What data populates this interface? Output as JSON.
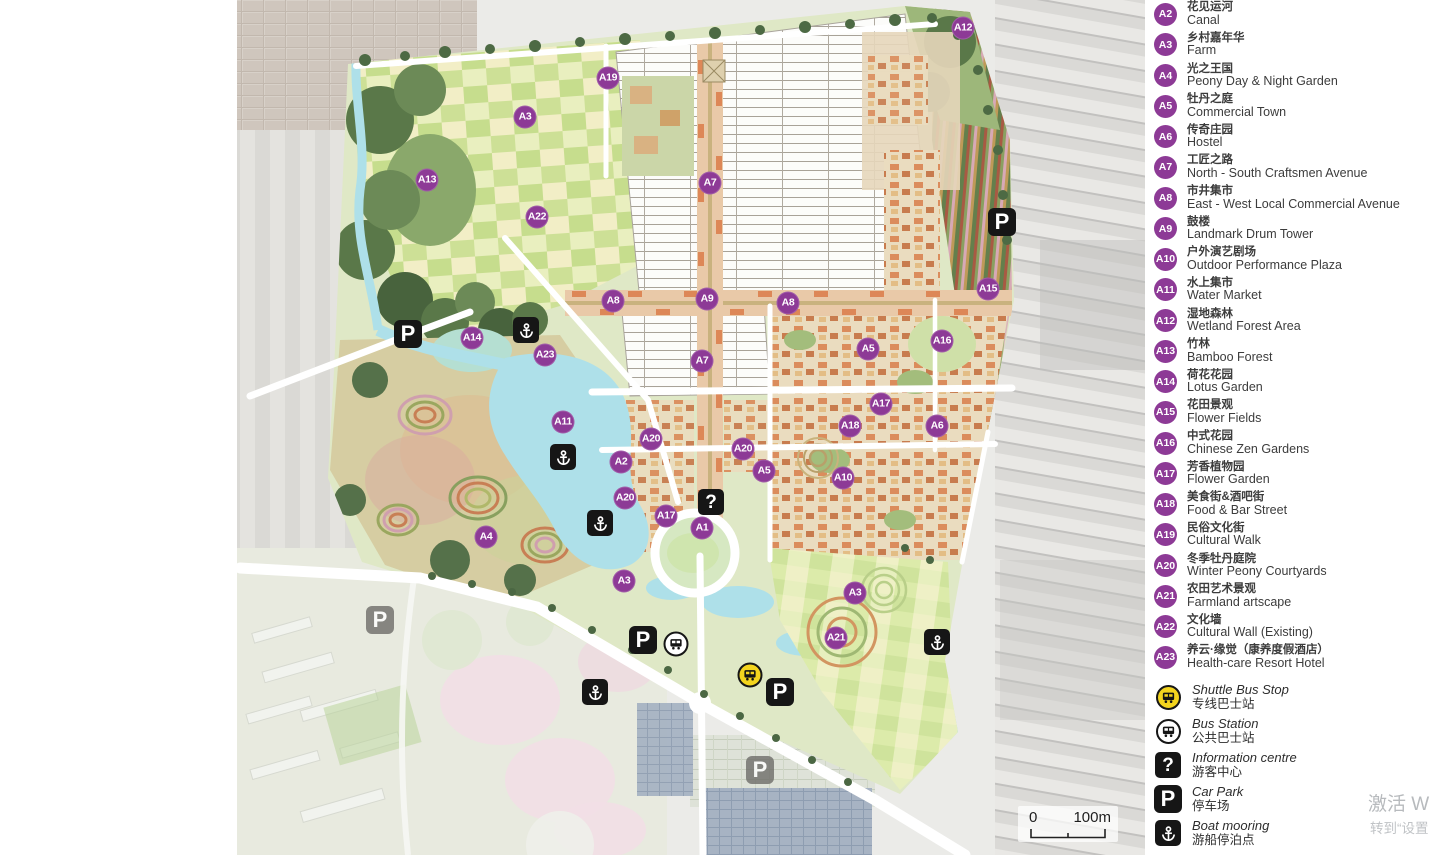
{
  "colors": {
    "marker": "#8d3a96",
    "shuttle": "#f3d41e",
    "icon_black": "#161616",
    "water": "#aee0e9"
  },
  "map": {
    "glyphs": {
      "p": "P",
      "q": "?"
    },
    "markers": [
      {
        "label": "A12",
        "x": 963,
        "y": 28
      },
      {
        "label": "A19",
        "x": 608,
        "y": 78
      },
      {
        "label": "A3",
        "x": 525,
        "y": 117
      },
      {
        "label": "A13",
        "x": 427,
        "y": 180
      },
      {
        "label": "A7",
        "x": 710,
        "y": 183
      },
      {
        "label": "A22",
        "x": 537,
        "y": 217
      },
      {
        "label": "A15",
        "x": 988,
        "y": 289
      },
      {
        "label": "A9",
        "x": 707,
        "y": 299
      },
      {
        "label": "A8",
        "x": 613,
        "y": 301
      },
      {
        "label": "A8",
        "x": 788,
        "y": 303
      },
      {
        "label": "A14",
        "x": 472,
        "y": 338
      },
      {
        "label": "A16",
        "x": 942,
        "y": 341
      },
      {
        "label": "A5",
        "x": 868,
        "y": 349
      },
      {
        "label": "A23",
        "x": 545,
        "y": 355
      },
      {
        "label": "A7",
        "x": 702,
        "y": 361
      },
      {
        "label": "A17",
        "x": 881,
        "y": 404
      },
      {
        "label": "A11",
        "x": 563,
        "y": 422
      },
      {
        "label": "A18",
        "x": 850,
        "y": 426
      },
      {
        "label": "A6",
        "x": 937,
        "y": 426
      },
      {
        "label": "A20",
        "x": 651,
        "y": 439
      },
      {
        "label": "A20",
        "x": 743,
        "y": 449
      },
      {
        "label": "A2",
        "x": 621,
        "y": 462
      },
      {
        "label": "A5",
        "x": 764,
        "y": 471
      },
      {
        "label": "A10",
        "x": 843,
        "y": 478
      },
      {
        "label": "A20",
        "x": 625,
        "y": 498
      },
      {
        "label": "A17",
        "x": 666,
        "y": 516
      },
      {
        "label": "A1",
        "x": 702,
        "y": 528
      },
      {
        "label": "A4",
        "x": 486,
        "y": 537
      },
      {
        "label": "A3",
        "x": 624,
        "y": 581
      },
      {
        "label": "A3",
        "x": 855,
        "y": 593
      },
      {
        "label": "A21",
        "x": 836,
        "y": 638
      }
    ],
    "icons": [
      {
        "type": "car-park",
        "variant": "black",
        "x": 1002,
        "y": 222
      },
      {
        "type": "car-park",
        "variant": "black",
        "x": 408,
        "y": 334
      },
      {
        "type": "car-park",
        "variant": "gray",
        "x": 380,
        "y": 620
      },
      {
        "type": "car-park",
        "variant": "black",
        "x": 643,
        "y": 640
      },
      {
        "type": "car-park",
        "variant": "black",
        "x": 780,
        "y": 692
      },
      {
        "type": "car-park",
        "variant": "gray",
        "x": 760,
        "y": 770
      },
      {
        "type": "boat-mooring",
        "x": 526,
        "y": 330
      },
      {
        "type": "boat-mooring",
        "x": 563,
        "y": 457
      },
      {
        "type": "boat-mooring",
        "x": 600,
        "y": 523
      },
      {
        "type": "boat-mooring",
        "x": 937,
        "y": 642
      },
      {
        "type": "boat-mooring",
        "x": 595,
        "y": 692
      },
      {
        "type": "bus-station",
        "x": 676,
        "y": 644
      },
      {
        "type": "shuttle-bus",
        "x": 750,
        "y": 675
      },
      {
        "type": "information",
        "x": 711,
        "y": 502
      }
    ]
  },
  "legend": {
    "items": [
      {
        "id": "A2",
        "zh": "花见运河",
        "en": "Canal"
      },
      {
        "id": "A3",
        "zh": "乡村嘉年华",
        "en": "Farm"
      },
      {
        "id": "A4",
        "zh": "光之王国",
        "en": "Peony Day & Night Garden"
      },
      {
        "id": "A5",
        "zh": "牡丹之庭",
        "en": "Commercial Town"
      },
      {
        "id": "A6",
        "zh": "传奇庄园",
        "en": "Hostel"
      },
      {
        "id": "A7",
        "zh": "工匠之路",
        "en": "North - South Craftsmen Avenue"
      },
      {
        "id": "A8",
        "zh": "市井集市",
        "en": "East - West Local Commercial Avenue"
      },
      {
        "id": "A9",
        "zh": "鼓楼",
        "en": "Landmark Drum Tower"
      },
      {
        "id": "A10",
        "zh": "户外演艺剧场",
        "en": "Outdoor Performance Plaza"
      },
      {
        "id": "A11",
        "zh": "水上集市",
        "en": "Water Market"
      },
      {
        "id": "A12",
        "zh": "湿地森林",
        "en": "Wetland Forest Area"
      },
      {
        "id": "A13",
        "zh": "竹林",
        "en": "Bamboo Forest"
      },
      {
        "id": "A14",
        "zh": "荷花花园",
        "en": "Lotus Garden"
      },
      {
        "id": "A15",
        "zh": "花田景观",
        "en": "Flower Fields"
      },
      {
        "id": "A16",
        "zh": "中式花园",
        "en": "Chinese Zen Gardens"
      },
      {
        "id": "A17",
        "zh": "芳香植物园",
        "en": "Flower Garden"
      },
      {
        "id": "A18",
        "zh": "美食街&酒吧街",
        "en": "Food & Bar Street"
      },
      {
        "id": "A19",
        "zh": "民俗文化街",
        "en": "Cultural Walk"
      },
      {
        "id": "A20",
        "zh": "冬季牡丹庭院",
        "en": "Winter Peony Courtyards"
      },
      {
        "id": "A21",
        "zh": "农田艺术景观",
        "en": "Farmland artscape"
      },
      {
        "id": "A22",
        "zh": "文化墙",
        "en": "Cultural Wall (Existing)"
      },
      {
        "id": "A23",
        "zh": "养云·缘觉（康养度假酒店）",
        "en": "Health-care Resort Hotel"
      }
    ],
    "transport": [
      {
        "type": "shuttle-bus",
        "en": "Shuttle Bus Stop",
        "zh": "专线巴士站"
      },
      {
        "type": "bus-station",
        "en": "Bus Station",
        "zh": "公共巴士站"
      },
      {
        "type": "information",
        "en": "Information centre",
        "zh": "游客中心"
      },
      {
        "type": "car-park",
        "en": "Car Park",
        "zh": "停车场"
      },
      {
        "type": "boat-mooring",
        "en": "Boat mooring",
        "zh": "游船停泊点"
      }
    ]
  },
  "scale_bar": {
    "zero": "0",
    "hundred": "100m"
  },
  "watermark": {
    "line1": "激活 W",
    "line2": "转到“设置"
  }
}
